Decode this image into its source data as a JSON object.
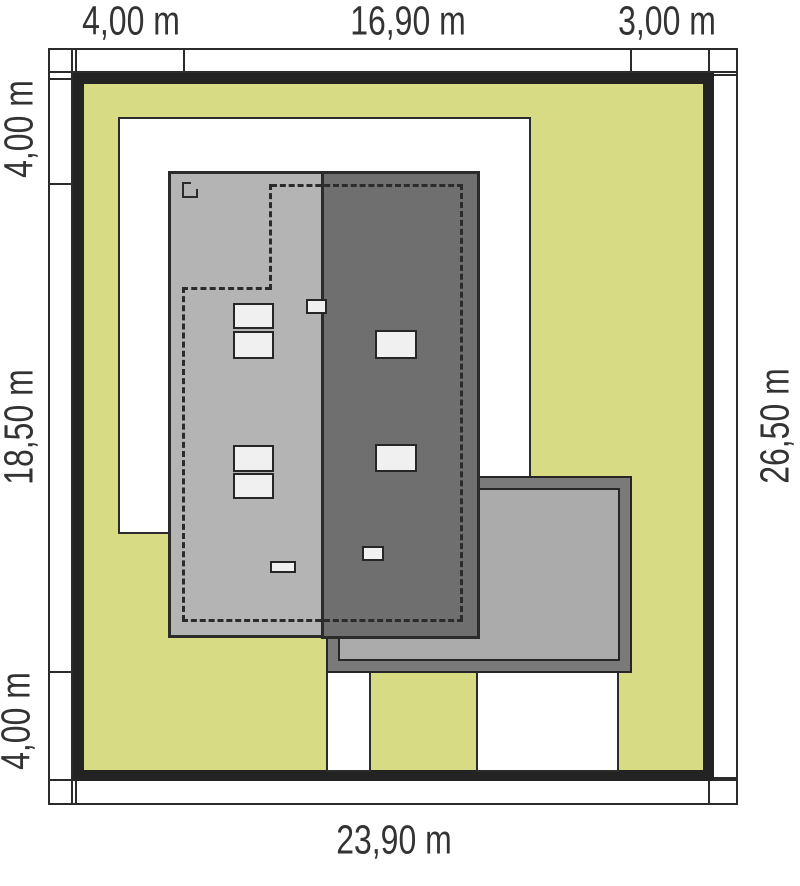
{
  "plan": {
    "title": "site-plan",
    "dimensions": {
      "top": [
        "4,00 m",
        "16,90 m",
        "3,00 m"
      ],
      "left": [
        "4,00 m",
        "18,50 m",
        "4,00 m"
      ],
      "right": [
        "26,50 m"
      ],
      "bottom": [
        "23,90 m"
      ]
    },
    "colors": {
      "lawn": "#d6db84",
      "roof_light": "#b4b4b4",
      "roof_dark": "#6f6f6f",
      "terrace_frame": "#7a7a7a",
      "terrace_inner": "#ababab",
      "window": "#f0f0f0",
      "line": "#2b2b2b",
      "background": "#ffffff"
    }
  }
}
